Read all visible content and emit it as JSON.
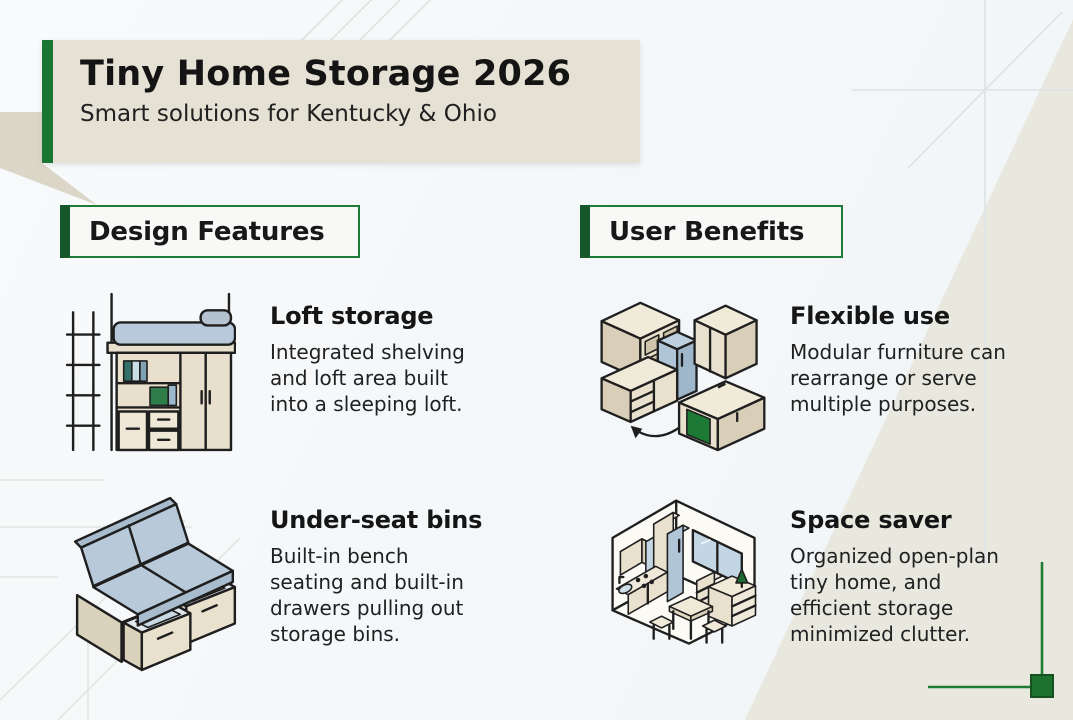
{
  "header": {
    "title": "Tiny Home Storage 2026",
    "subtitle": "Smart solutions for Kentucky & Ohio"
  },
  "columns": [
    {
      "heading": "Design Features",
      "items": [
        {
          "icon": "loft-bed-icon",
          "title": "Loft storage",
          "description": "Integrated shelving\nand loft area built\ninto a sleeping loft."
        },
        {
          "icon": "bench-storage-drawers-icon",
          "title": "Under-seat bins",
          "description": "Built-in bench\nseating and built-in\ndrawers pulling out\nstorage bins."
        }
      ]
    },
    {
      "heading": "User Benefits",
      "items": [
        {
          "icon": "modular-furniture-icon",
          "title": "Flexible use",
          "description": "Modular furniture can\nrearrange or serve\nmultiple purposes."
        },
        {
          "icon": "tiny-home-floorplan-icon",
          "title": "Space saver",
          "description": "Organized open-plan\ntiny home, and\nefficient storage\nminimized clutter."
        }
      ]
    }
  ],
  "colors": {
    "accent_green": "#1e7c36",
    "dark_green_bar": "#17582a",
    "header_beige": "#e5e1d4",
    "cushion_blue": "#b8cada",
    "furniture_beige": "#e9e1cd"
  }
}
